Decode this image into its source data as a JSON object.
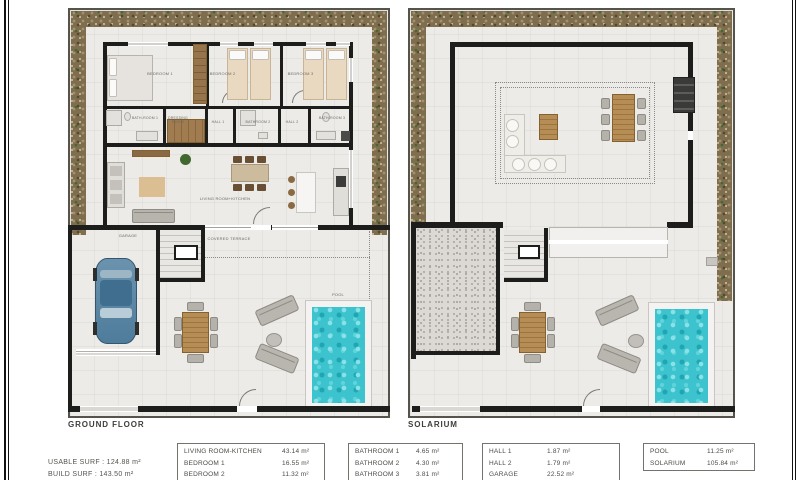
{
  "captions": {
    "ground_floor": "GROUND FLOOR",
    "solarium": "SOLARIUM",
    "usable_surf": "USABLE SURF : 124.88 m²",
    "build_surf": "BUILD SURF : 143.50 m²"
  },
  "ground_floor_rooms": {
    "bedroom1": "BEDROOM 1",
    "bedroom2": "BEDROOM 2",
    "bedroom3": "BEDROOM 3",
    "bathroom1": "BATH-ROOM 1",
    "dressing": "DRESSING ROOM",
    "hall1": "HALL 1",
    "bathroom2": "BATHROOM 2",
    "hall2": "HALL 2",
    "bathroom3": "BATH-ROOM 3",
    "living": "LIVING ROOM+KITCHEN",
    "garage": "GARAGE",
    "terrace": "COVERED TERRACE",
    "pool": "POOL"
  },
  "area_tables": {
    "t1": {
      "rows": [
        {
          "name": "LIVING ROOM-KITCHEN",
          "value": "43.14 m²"
        },
        {
          "name": "BEDROOM 1",
          "value": "16.55 m²"
        },
        {
          "name": "BEDROOM 2",
          "value": "11.32 m²"
        }
      ]
    },
    "t2": {
      "rows": [
        {
          "name": "BATHROOM 1",
          "value": "4.65 m²"
        },
        {
          "name": "BATHROOM 2",
          "value": "4.30 m²"
        },
        {
          "name": "BATHROOM 3",
          "value": "3.81 m²"
        }
      ]
    },
    "t3": {
      "rows": [
        {
          "name": "HALL 1",
          "value": "1.87 m²"
        },
        {
          "name": "HALL 2",
          "value": "1.79 m²"
        },
        {
          "name": "GARAGE",
          "value": "22.52 m²"
        }
      ]
    },
    "t4": {
      "rows": [
        {
          "name": "POOL",
          "value": "11.25 m²"
        },
        {
          "name": "SOLARIUM",
          "value": "105.84 m²"
        }
      ]
    }
  },
  "colors": {
    "wall": "#1d1d1b",
    "floor": "#edebe8",
    "plan_border": "#56534d",
    "pool": "#3cc3cd",
    "wood": "#aa8450",
    "car": "#5d88a7"
  }
}
